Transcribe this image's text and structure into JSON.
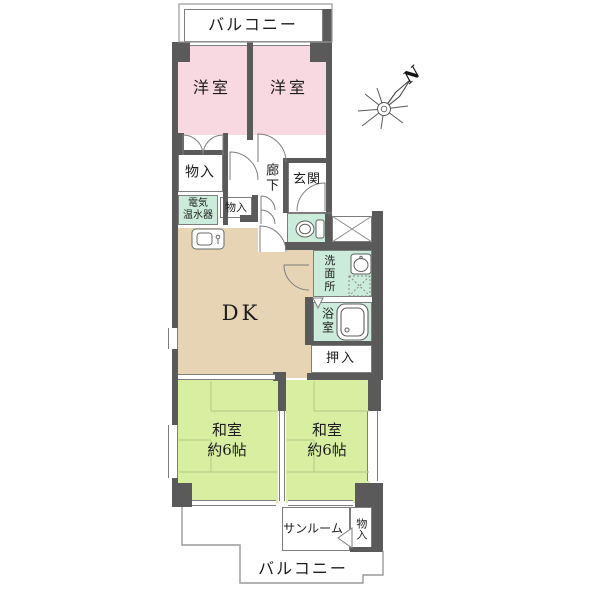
{
  "colors": {
    "wall": "#5a5a5a",
    "pink": "#f9d9e1",
    "green": "#d8efa2",
    "mint": "#cbecdb",
    "tan": "#e7d4b5",
    "border": "#7d7d7d",
    "thin": "#9a9a9a",
    "tatami": "#b7cf8a",
    "text": "#1c1c1c"
  },
  "rooms": {
    "balcony_top": {
      "label": "バルコニー"
    },
    "western_left": {
      "label": "洋室"
    },
    "western_right": {
      "label": "洋室"
    },
    "storage_top": {
      "label": "物入"
    },
    "corridor": {
      "label": "廊下"
    },
    "entrance": {
      "label": "玄関"
    },
    "water_heater": {
      "line1": "電気",
      "line2": "温水器"
    },
    "storage_mid": {
      "label": "物入"
    },
    "dk": {
      "label": "DK"
    },
    "washroom": {
      "label": "洗面所"
    },
    "bathroom": {
      "label": "浴室"
    },
    "closet": {
      "label": "押入"
    },
    "japanese_left": {
      "line1": "和室",
      "line2": "約6帖"
    },
    "japanese_right": {
      "line1": "和室",
      "line2": "約6帖"
    },
    "sunroom": {
      "label": "サンルーム"
    },
    "storage_bottom": {
      "label": "物入"
    },
    "balcony_bottom": {
      "label": "バルコニー"
    }
  },
  "compass": {
    "north": "N"
  },
  "icons": {
    "compass": "compass-rose-north-arrow",
    "toilet": "toilet",
    "bathtub": "bathtub",
    "washbasin": "washbasin",
    "washing_machine": "washing-machine-space-dotted",
    "kitchen_sink": "kitchen-sink",
    "shaft": "crossed-box-shaft",
    "door_arc": "door-swing-arc"
  }
}
